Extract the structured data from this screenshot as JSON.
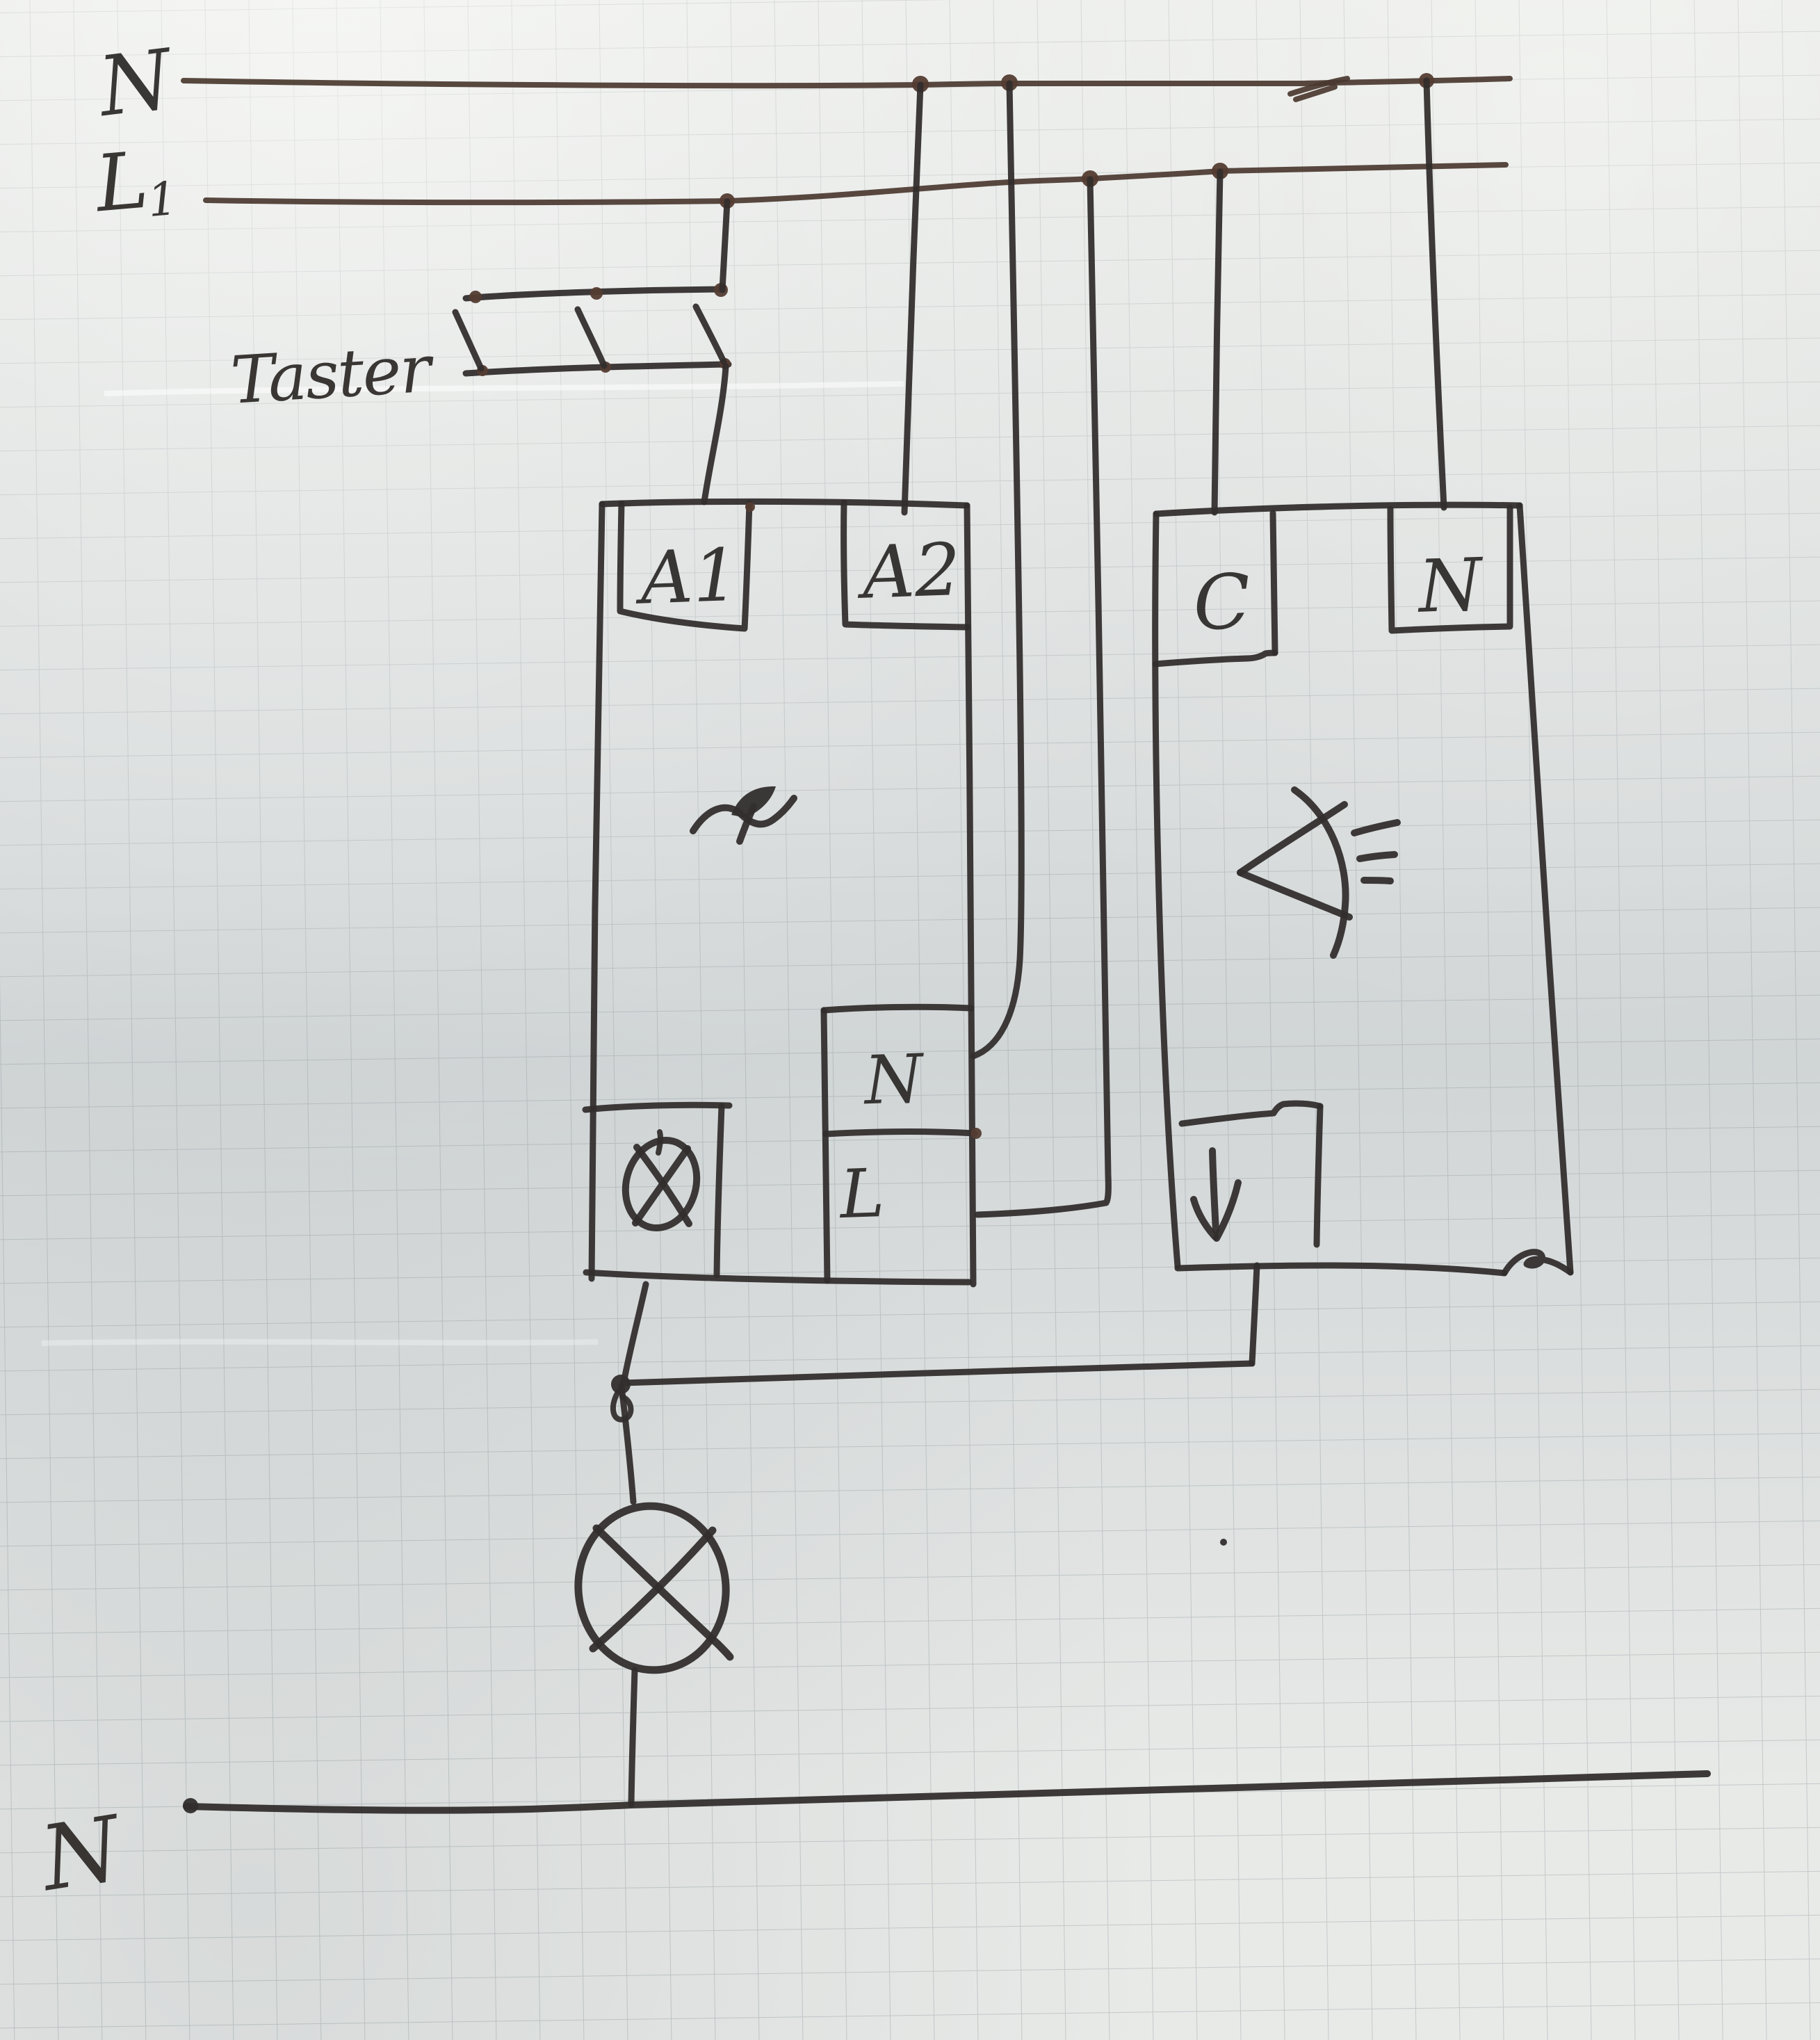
{
  "labels": {
    "bus_neutral_top": "N",
    "bus_phase": "L",
    "bus_phase_subscript": "1",
    "pushbutton_group": "Taster",
    "relay_terminal_a1": "A1",
    "relay_terminal_a2": "A2",
    "relay_terminal_neutral": "N",
    "relay_terminal_line": "L",
    "sensor_terminal_c": "C",
    "sensor_terminal_n": "N",
    "bus_neutral_bottom": "N"
  },
  "symbols": {
    "relay_coil": "wave-with-arrow",
    "relay_lamp_output": "circle-cross-lamp",
    "sensor": "light-sensor-with-rays",
    "sensor_output": "down-arrow",
    "lamp": "circle-cross-lamp",
    "pushbutton_contacts": 3
  },
  "colors": {
    "ink": "#322e2d",
    "ink_warm": "#4a382f",
    "paper": "#e8eae8",
    "grid_line": "#9fa8ac"
  }
}
